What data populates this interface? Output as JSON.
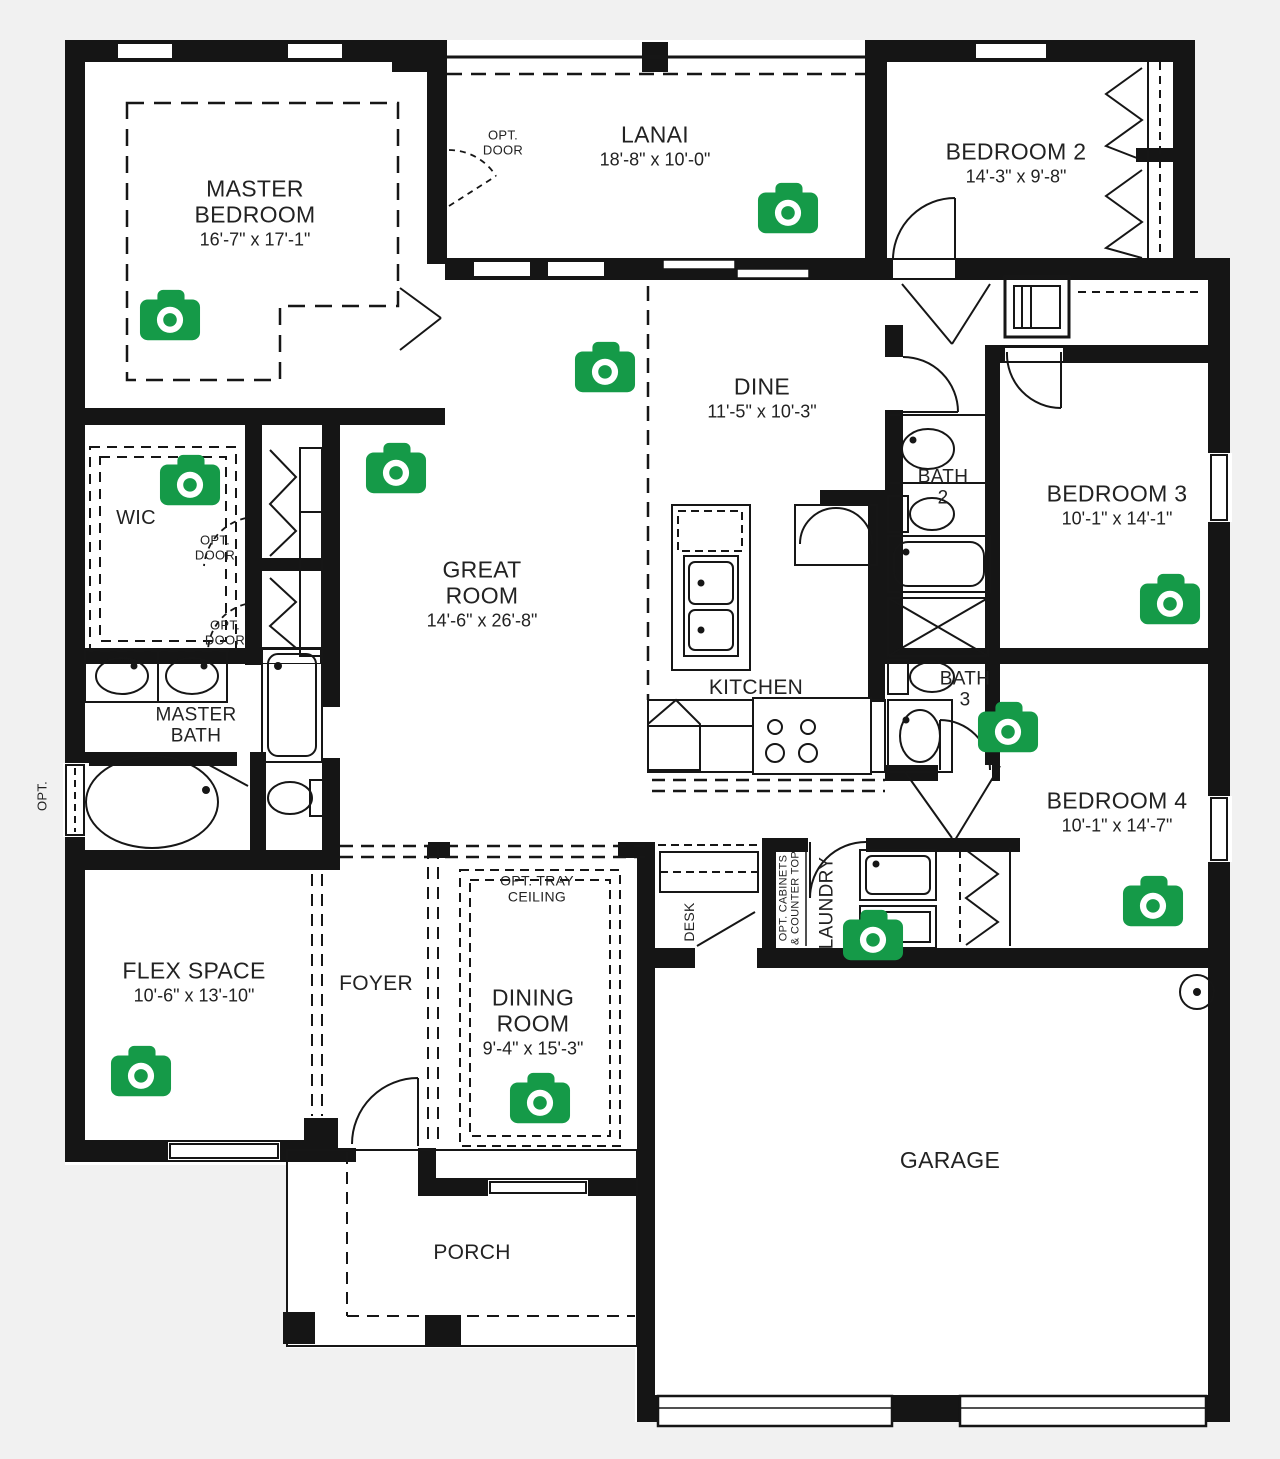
{
  "colors": {
    "background": "#f1f1f1",
    "floor": "#ffffff",
    "wall": "#151515",
    "camera_green": "#159a48",
    "text": "#222222"
  },
  "labels": [
    {
      "id": "master-bedroom",
      "lines": [
        "MASTER",
        "BEDROOM"
      ],
      "dims": "16'-7\" x 17'-1\"",
      "x": 255,
      "y": 213,
      "size": 23,
      "dsize": 18
    },
    {
      "id": "lanai",
      "lines": [
        "LANAI"
      ],
      "dims": "18'-8\" x 10'-0\"",
      "x": 655,
      "y": 146,
      "size": 23,
      "dsize": 18
    },
    {
      "id": "opt-door-lanai",
      "lines": [
        "OPT.",
        "DOOR"
      ],
      "x": 503,
      "y": 143,
      "size": 13
    },
    {
      "id": "bedroom-2",
      "lines": [
        "BEDROOM 2"
      ],
      "dims": "14'-3\" x 9'-8\"",
      "x": 1016,
      "y": 163,
      "size": 23,
      "dsize": 18
    },
    {
      "id": "dine",
      "lines": [
        "DINE"
      ],
      "dims": "11'-5\" x 10'-3\"",
      "x": 762,
      "y": 398,
      "size": 23,
      "dsize": 18
    },
    {
      "id": "bath-2",
      "lines": [
        "BATH",
        "2"
      ],
      "x": 943,
      "y": 488,
      "size": 19
    },
    {
      "id": "bedroom-3",
      "lines": [
        "BEDROOM 3"
      ],
      "dims": "10'-1\" x 14'-1\"",
      "x": 1117,
      "y": 505,
      "size": 23,
      "dsize": 18
    },
    {
      "id": "wic",
      "lines": [
        "WIC"
      ],
      "x": 136,
      "y": 518,
      "size": 20
    },
    {
      "id": "opt-door-1",
      "lines": [
        "OPT.",
        "DOOR"
      ],
      "x": 215,
      "y": 548,
      "size": 13
    },
    {
      "id": "opt-door-2",
      "lines": [
        "OPT.",
        "DOOR"
      ],
      "x": 225,
      "y": 633,
      "size": 13
    },
    {
      "id": "great-room",
      "lines": [
        "GREAT",
        "ROOM"
      ],
      "dims": "14'-6\" x 26'-8\"",
      "x": 482,
      "y": 594,
      "size": 23,
      "dsize": 18
    },
    {
      "id": "kitchen",
      "lines": [
        "KITCHEN"
      ],
      "x": 756,
      "y": 688,
      "size": 21
    },
    {
      "id": "bath-3",
      "lines": [
        "BATH",
        "3"
      ],
      "x": 965,
      "y": 690,
      "size": 19
    },
    {
      "id": "master-bath",
      "lines": [
        "MASTER",
        "BATH"
      ],
      "x": 196,
      "y": 726,
      "size": 19
    },
    {
      "id": "bedroom-4",
      "lines": [
        "BEDROOM 4"
      ],
      "dims": "10'-1\" x 14'-7\"",
      "x": 1117,
      "y": 812,
      "size": 23,
      "dsize": 18
    },
    {
      "id": "opt-window",
      "lines": [
        "OPT."
      ],
      "x": 43,
      "y": 796,
      "size": 13,
      "rotate": true
    },
    {
      "id": "desk",
      "lines": [
        "DESK"
      ],
      "x": 690,
      "y": 922,
      "size": 14,
      "rotate": true
    },
    {
      "id": "opt-cabinets",
      "lines": [
        "OPT. CABINETS",
        "& COUNTER TOP"
      ],
      "x": 790,
      "y": 898,
      "size": 11,
      "rotate": true
    },
    {
      "id": "laundry",
      "lines": [
        "LAUNDRY"
      ],
      "x": 827,
      "y": 903,
      "size": 19,
      "rotate": true
    },
    {
      "id": "flex-space",
      "lines": [
        "FLEX SPACE"
      ],
      "dims": "10'-6\" x 13'-10\"",
      "x": 194,
      "y": 982,
      "size": 23,
      "dsize": 18
    },
    {
      "id": "foyer",
      "lines": [
        "FOYER"
      ],
      "x": 376,
      "y": 984,
      "size": 21
    },
    {
      "id": "opt-tray-ceiling",
      "lines": [
        "OPT. TRAY",
        "CEILING"
      ],
      "x": 537,
      "y": 889,
      "size": 14
    },
    {
      "id": "dining-room",
      "lines": [
        "DINING",
        "ROOM"
      ],
      "dims": "9'-4\" x 15'-3\"",
      "x": 533,
      "y": 1022,
      "size": 23,
      "dsize": 18
    },
    {
      "id": "garage",
      "lines": [
        "GARAGE"
      ],
      "x": 950,
      "y": 1161,
      "size": 23
    },
    {
      "id": "porch",
      "lines": [
        "PORCH"
      ],
      "x": 472,
      "y": 1253,
      "size": 21
    }
  ],
  "cameras": [
    {
      "id": "master-bedroom",
      "x": 170,
      "y": 315
    },
    {
      "id": "wic",
      "x": 190,
      "y": 480
    },
    {
      "id": "great-room",
      "x": 396,
      "y": 468
    },
    {
      "id": "dine",
      "x": 605,
      "y": 367
    },
    {
      "id": "lanai",
      "x": 788,
      "y": 208
    },
    {
      "id": "bedroom-3",
      "x": 1170,
      "y": 599
    },
    {
      "id": "bath-3",
      "x": 1008,
      "y": 727
    },
    {
      "id": "bedroom-4",
      "x": 1153,
      "y": 901
    },
    {
      "id": "laundry",
      "x": 873,
      "y": 935
    },
    {
      "id": "flex-space",
      "x": 141,
      "y": 1071
    },
    {
      "id": "dining-room",
      "x": 540,
      "y": 1098
    }
  ]
}
